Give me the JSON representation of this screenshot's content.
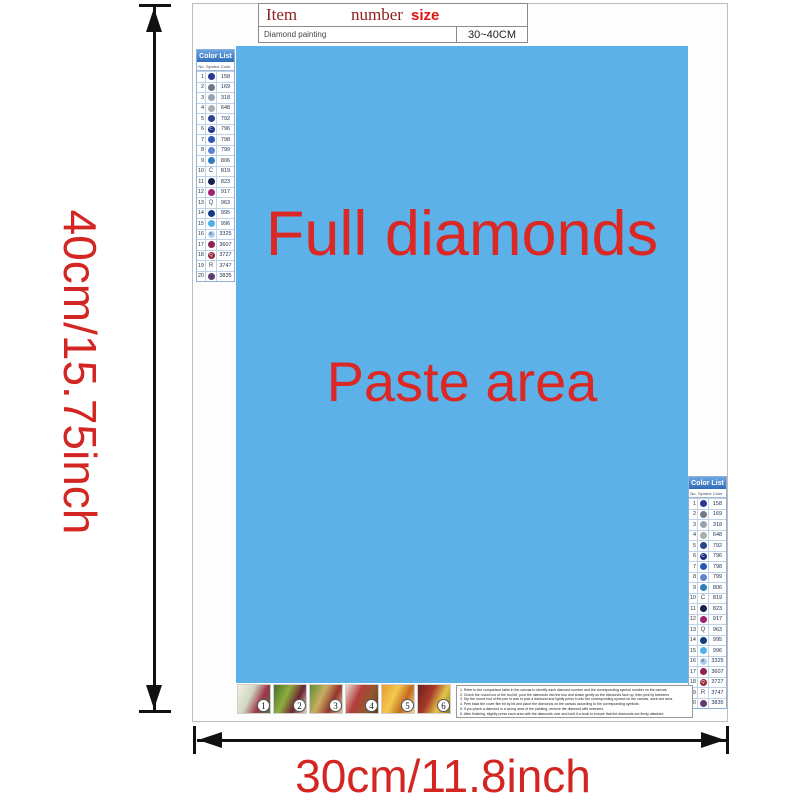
{
  "item_table": {
    "headers": {
      "item": "Item",
      "number": "number",
      "size": "size"
    },
    "row": {
      "name": "Diamond painting",
      "size": "30~40CM"
    }
  },
  "paste_area": {
    "line1": "Full diamonds",
    "line2": "Paste area",
    "bg_color": "#5bb1e8",
    "text_color": "#dc2824"
  },
  "color_list": {
    "title": "Color List",
    "columns": {
      "no": "No.",
      "symbol": "Symbol",
      "color": "Color"
    },
    "rows": [
      {
        "no": "1",
        "code": "158",
        "t": "",
        "circle": "#2a3694",
        "fg": "#ffffff"
      },
      {
        "no": "2",
        "code": "169",
        "t": "",
        "circle": "#707788",
        "fg": "#ffffff"
      },
      {
        "no": "3",
        "code": "318",
        "t": "",
        "circle": "#97a2b0",
        "fg": "#ffffff"
      },
      {
        "no": "4",
        "code": "648",
        "t": "",
        "circle": "#a9adaf",
        "fg": "#ffffff"
      },
      {
        "no": "5",
        "code": "792",
        "t": "",
        "circle": "#2c418f",
        "fg": "#ffffff"
      },
      {
        "no": "6",
        "code": "796",
        "t": "C",
        "circle": "#1c2f85",
        "fg": "#ffffff"
      },
      {
        "no": "7",
        "code": "798",
        "t": "",
        "circle": "#2d55b2",
        "fg": "#ffffff"
      },
      {
        "no": "8",
        "code": "799",
        "t": "",
        "circle": "#5d84cd",
        "fg": "#ffffff"
      },
      {
        "no": "9",
        "code": "806",
        "t": "",
        "circle": "#2e7dc0",
        "fg": "#ffffff"
      },
      {
        "no": "10",
        "code": "819",
        "t": "C",
        "circle": null,
        "fg": "#3a3f55"
      },
      {
        "no": "11",
        "code": "823",
        "t": "",
        "circle": "#16204f",
        "fg": "#ffffff"
      },
      {
        "no": "12",
        "code": "917",
        "t": "",
        "circle": "#a02173",
        "fg": "#ffffff"
      },
      {
        "no": "13",
        "code": "963",
        "t": "Q",
        "circle": null,
        "fg": "#3a3f55"
      },
      {
        "no": "14",
        "code": "995",
        "t": "",
        "circle": "#123c80",
        "fg": "#ffffff"
      },
      {
        "no": "15",
        "code": "996",
        "t": "",
        "circle": "#4fb0e6",
        "fg": "#ffffff"
      },
      {
        "no": "16",
        "code": "3325",
        "t": "K",
        "circle": "#aed0ec",
        "fg": "#223355"
      },
      {
        "no": "17",
        "code": "3607",
        "t": "",
        "circle": "#8f2153",
        "fg": "#ffffff"
      },
      {
        "no": "18",
        "code": "3727",
        "t": "Q",
        "circle": "#97293c",
        "fg": "#ffffff"
      },
      {
        "no": "19",
        "code": "3747",
        "t": "R",
        "circle": null,
        "fg": "#3a3f55"
      },
      {
        "no": "20",
        "code": "3835",
        "t": "",
        "circle": "#5d3a70",
        "fg": "#ffffff"
      }
    ]
  },
  "thumbnails": [
    {
      "n": "1",
      "colors": [
        "#f3efe4",
        "#cfd8c2",
        "#9e3448",
        "#4a7a3c"
      ]
    },
    {
      "n": "2",
      "colors": [
        "#45702c",
        "#8fae3f",
        "#6b2430",
        "#d8d2c2"
      ]
    },
    {
      "n": "3",
      "colors": [
        "#5d8f39",
        "#c8ae62",
        "#97322c",
        "#d9c694"
      ]
    },
    {
      "n": "4",
      "colors": [
        "#e9e2d2",
        "#b43c3c",
        "#92592c",
        "#5e3a20"
      ]
    },
    {
      "n": "5",
      "colors": [
        "#e99a2d",
        "#f2c94e",
        "#c2691f",
        "#f4da8e"
      ]
    },
    {
      "n": "6",
      "colors": [
        "#6d1f1f",
        "#a63a2a",
        "#e5c44a",
        "#857627"
      ]
    }
  ],
  "instructions": {
    "lines": [
      "1. Refer to the comparison table in the canvas to identify each diamond number and the corresponding symbol number on the canvas",
      "2. Check the round box of the tool kit, pour the diamonds into the box and shake gently so the diamonds face up, then pick by tweezers",
      "3. Dip the round end of the pen in wax to pick a diamond and lightly press it onto the corresponding symbol on the canvas, work one area",
      "4. Peel back the cover film bit by bit and place the diamonds on the canvas according to the corresponding symbols",
      "5. If you place a diamond in a wrong area of the painting, remove the diamond with tweezers",
      "6. After finishing, slightly press each area with the diamonds over and hold it a book to ensure that the diamonds are firmly attached"
    ]
  },
  "dimensions": {
    "height_label": "40cm/15.75inch",
    "width_label": "30cm/11.8inch",
    "label_color": "#d32622"
  }
}
